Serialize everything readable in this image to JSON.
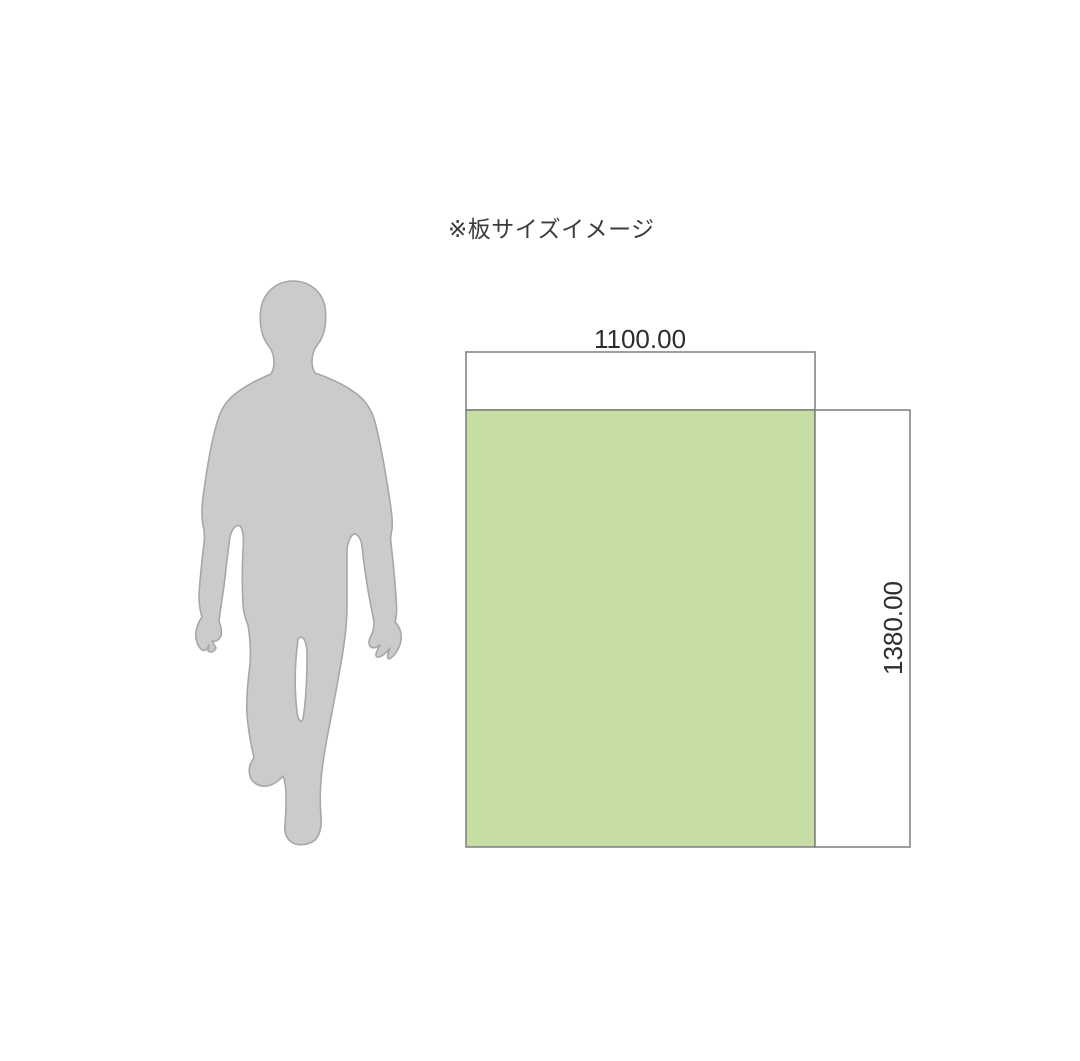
{
  "page": {
    "background_color": "#ffffff"
  },
  "title": "※板サイズイメージ",
  "board": {
    "width_label": "1100.00",
    "height_label": "1380.00",
    "fill_color": "#c6dda4",
    "outline_color": "#7d7d7d",
    "label_color": "#2e2e2e"
  },
  "silhouette": {
    "icon": "person-walking-silhouette",
    "fill_color": "#cbcbcd",
    "outline_color": "#a7a7aa"
  }
}
